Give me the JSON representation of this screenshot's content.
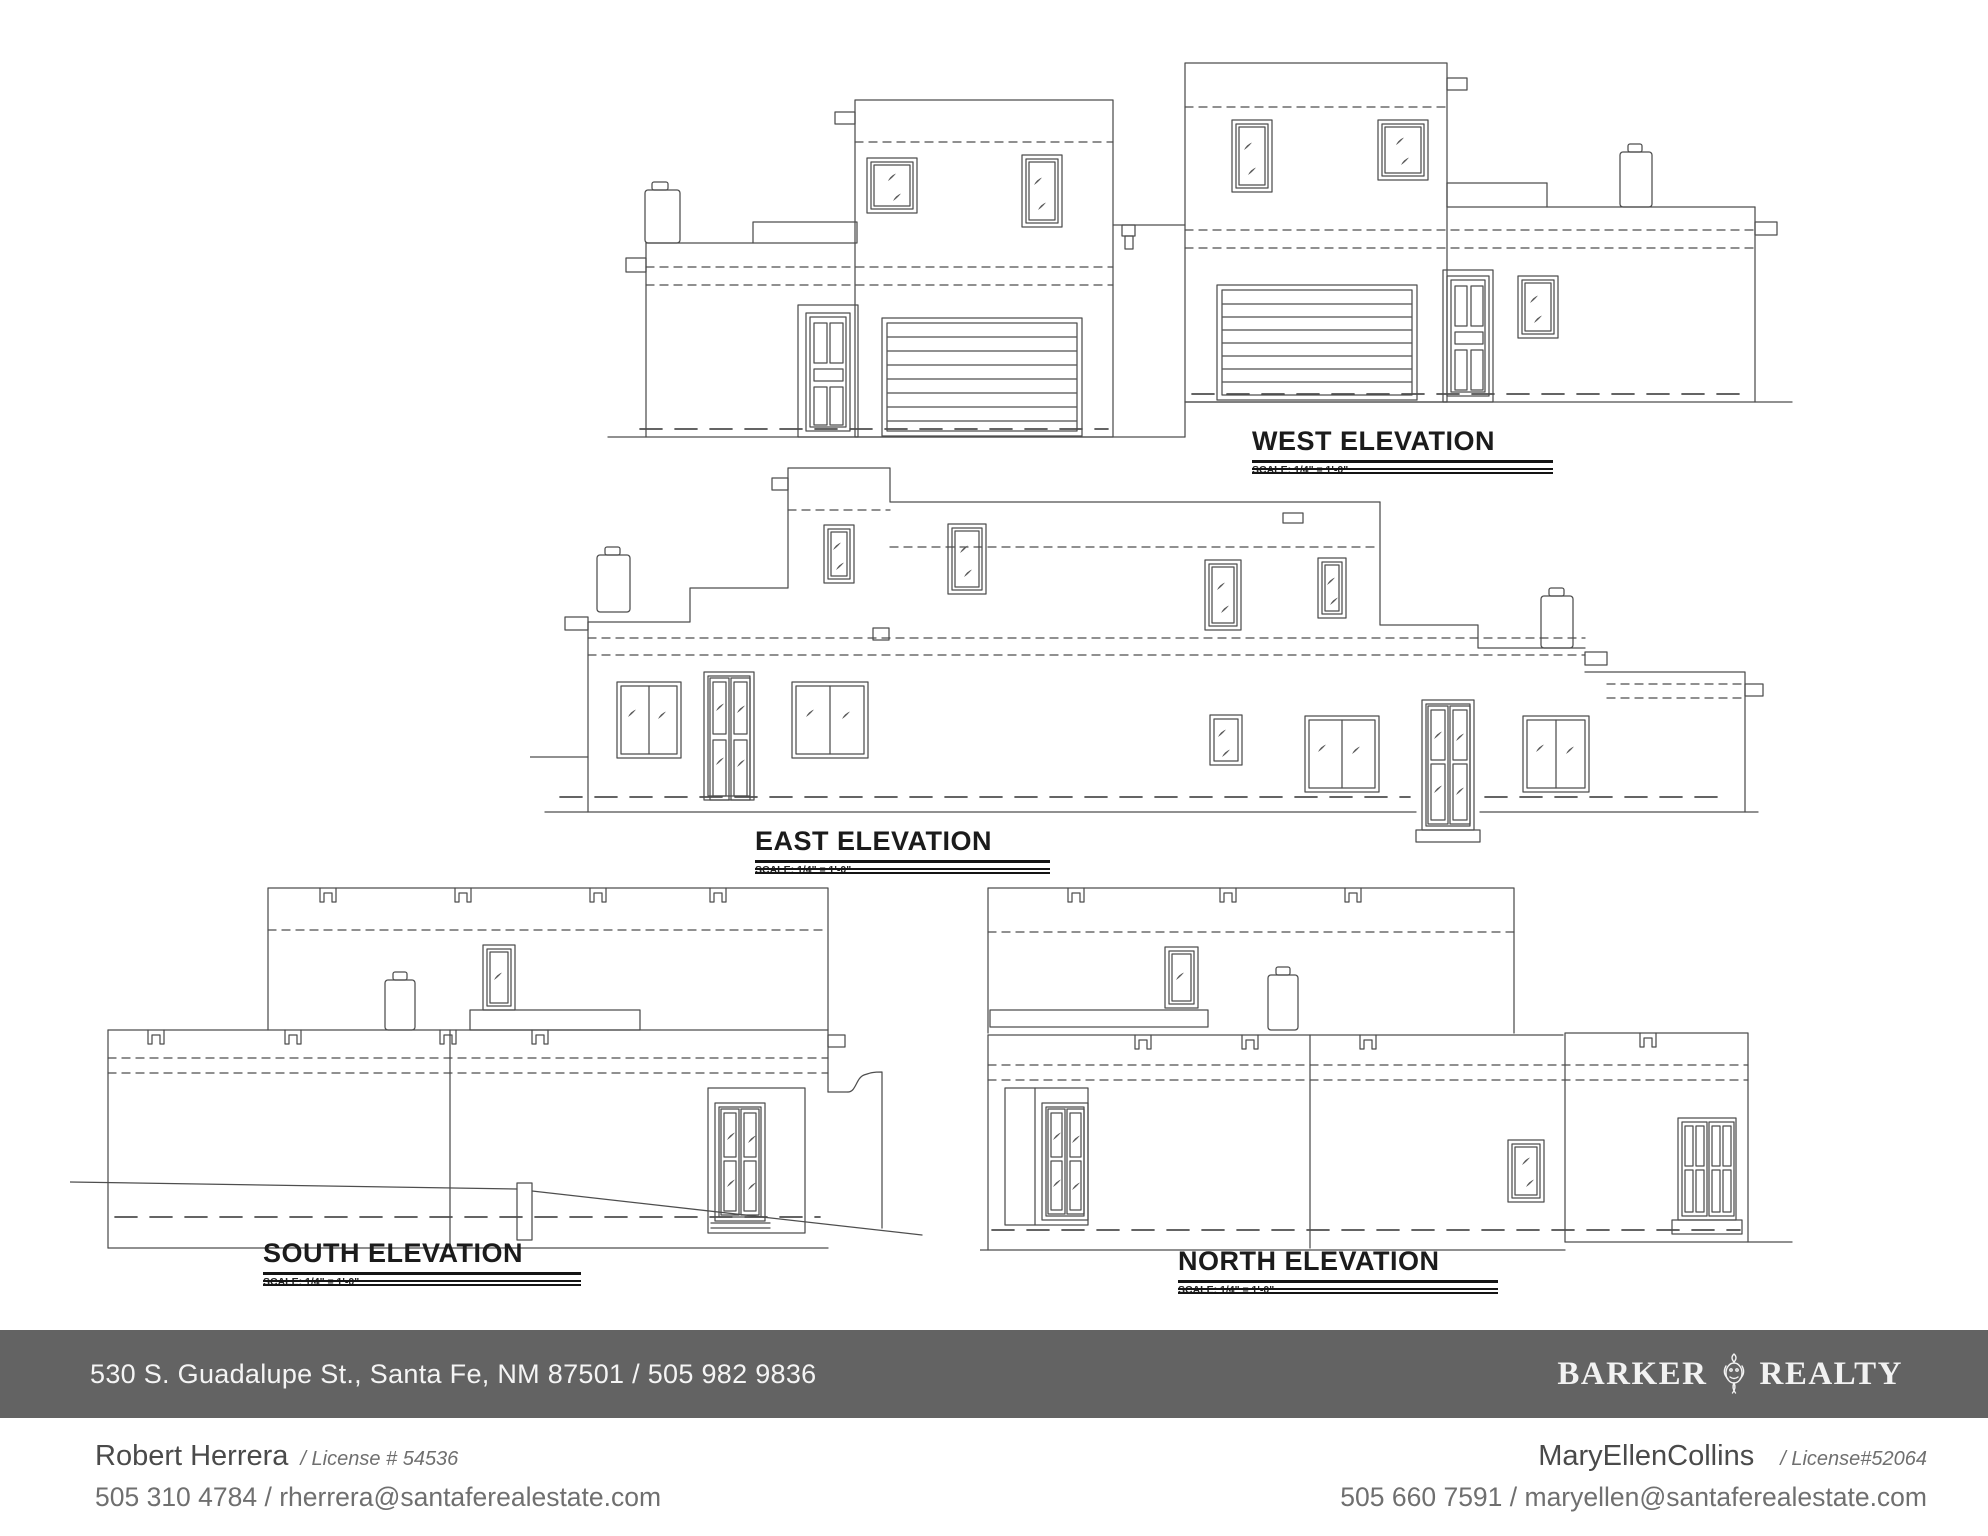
{
  "elevations": {
    "west": {
      "label": "WEST ELEVATION",
      "scale": "SCALE: 1/4\" = 1'-0\""
    },
    "east": {
      "label": "EAST ELEVATION",
      "scale": "SCALE: 1/4\" = 1'-0\""
    },
    "south": {
      "label": "SOUTH ELEVATION",
      "scale": "SCALE: 1/4\" = 1'-0\""
    },
    "north": {
      "label": "NORTH ELEVATION",
      "scale": "SCALE: 1/4\" = 1'-0\""
    }
  },
  "footer": {
    "address": "530 S. Guadalupe St., Santa Fe, NM 87501 / 505 982 9836",
    "brand": {
      "word1": "BARKER",
      "word2": "REALTY",
      "emblem_icon": "lion-crest-icon"
    },
    "colors": {
      "bar_background": "#636363",
      "bar_text": "#f4f4f4"
    }
  },
  "agents": {
    "left": {
      "name": "Robert Herrera",
      "license": "/ License # 54536",
      "contact": "505 310 4784 / rherrera@santaferealestate.com"
    },
    "right": {
      "name": "MaryEllenCollins",
      "license": "/ License#52064",
      "contact": "505 660 7591 / maryellen@santaferealestate.com"
    }
  },
  "drawing": {
    "line_color": "#4e4e4e"
  }
}
